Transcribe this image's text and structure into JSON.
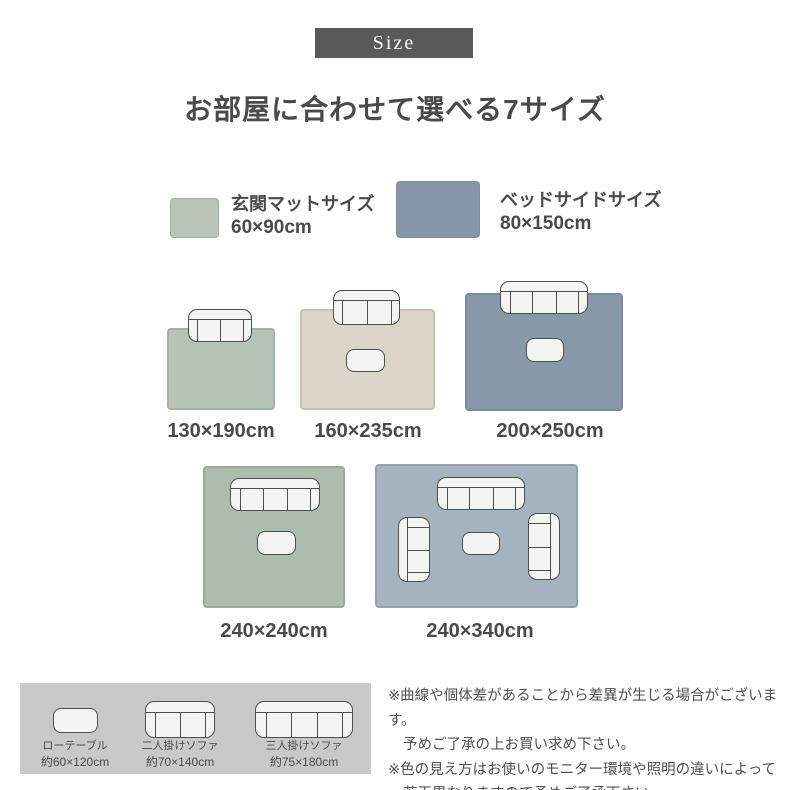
{
  "badge": {
    "label": "Size"
  },
  "title": "お部屋に合わせて選べる7サイズ",
  "legend": {
    "entrance_mat": {
      "label": "玄関マットサイズ",
      "size": "60×90cm",
      "swatch_color": "#b7c4b7"
    },
    "bedside": {
      "label": "ベッドサイドサイズ",
      "size": "80×150cm",
      "swatch_color": "#8496a8"
    }
  },
  "rugs": {
    "row1": [
      {
        "label": "130×190cm",
        "color": "#b5c4b7",
        "furniture": [
          "二人掛けソファ"
        ]
      },
      {
        "label": "160×235cm",
        "color": "#dbd4c8",
        "furniture": [
          "二人掛けソファ",
          "ローテーブル"
        ]
      },
      {
        "label": "200×250cm",
        "color": "#8899a9",
        "furniture": [
          "三人掛けソファ",
          "ローテーブル"
        ]
      }
    ],
    "row2": [
      {
        "label": "240×240cm",
        "color": "#aebcae",
        "furniture": [
          "三人掛けソファ",
          "ローテーブル"
        ]
      },
      {
        "label": "240×340cm",
        "color": "#a5b3c0",
        "furniture": [
          "三人掛けソファ",
          "二人掛けソファ",
          "二人掛けソファ",
          "ローテーブル"
        ]
      }
    ]
  },
  "furniture_legend": [
    {
      "name": "ローテーブル",
      "size": "約60×120cm"
    },
    {
      "name": "二人掛けソファ",
      "size": "約70×140cm"
    },
    {
      "name": "三人掛けソファ",
      "size": "約75×180cm"
    }
  ],
  "notes": [
    "※曲線や個体差があることから差異が生じる場合がございます。",
    "予めご了承の上お買い求め下さい。",
    "※色の見え方はお使いのモニター環境や照明の違いによって",
    "若干異なりますので予めご了承下さい。"
  ],
  "colors": {
    "badge_bg": "#595959",
    "text": "#4a4a4a",
    "green_rug": "#b5c4b7",
    "green_rug_dark": "#aebcae",
    "beige_rug": "#dbd4c8",
    "blue_rug": "#8899a9",
    "blue_rug_light": "#a5b3c0",
    "furniture_fill": "#f4f4f2",
    "furniture_stroke": "#4e4e4e",
    "legend_box_bg": "#c9c9c9"
  }
}
